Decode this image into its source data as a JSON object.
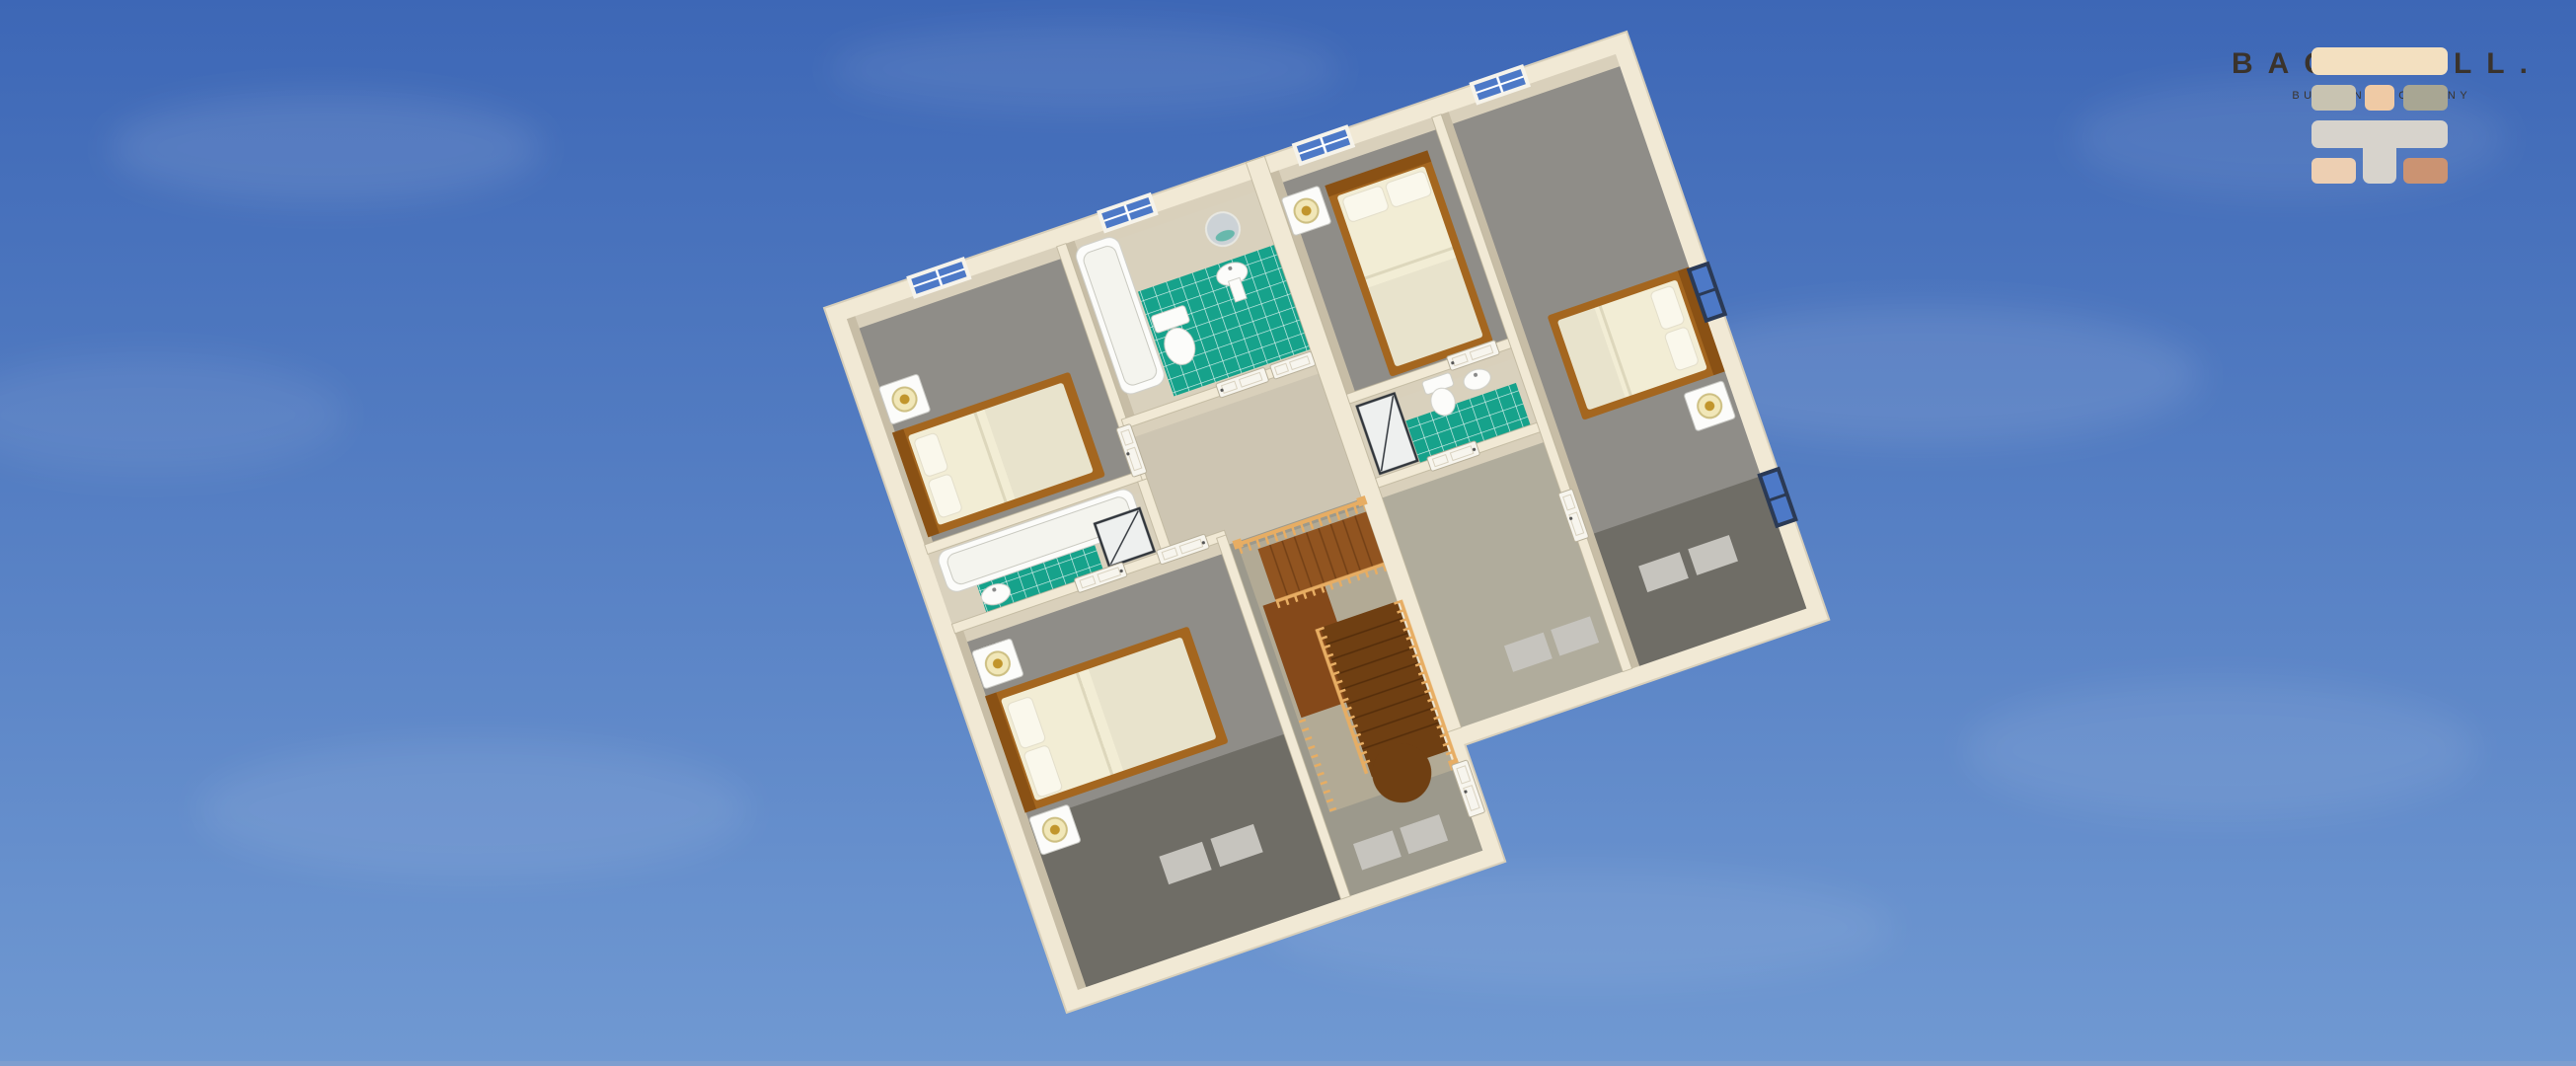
{
  "scene": {
    "description": "3D aerial dollhouse rendering of an upper-storey floor plan floating against a blue sky with faint clouds",
    "rooms": [
      "bedroom-top-left",
      "family-bathroom",
      "ensuite-bathroom-left",
      "master-bedroom",
      "hallway-landing",
      "staircase-u-shaped",
      "bedroom-top-right",
      "ensuite-bathroom-right",
      "bedroom-right",
      "hallway-right"
    ],
    "fixtures": {
      "beds": 4,
      "nightstands": 5,
      "lamps": 5,
      "toilets": 2,
      "sinks": 3,
      "bathtubs": 2,
      "showers": 2,
      "mirrors": 1,
      "windows": 6,
      "doors": 9
    },
    "floorplan_rotation_deg": -19
  },
  "logo": {
    "brand": "BACKWALL.",
    "tagline": "BUILDING COMPANY",
    "icon": "brick-wall-icon"
  },
  "palette": {
    "sky-top": "#3d67b6",
    "sky-bottom": "#7099d2",
    "sky-edge": "#8aa3cc",
    "wall-cream": "#f1e9d5",
    "wall-edge": "#c6bca4",
    "wall-face": "#d9d0bb",
    "wall-face-dark": "#c7bda6",
    "floor-beige": "#cdc5b2",
    "floor-bath": "#d9d1bd",
    "hall-olive": "#9c998c",
    "hall-right": "#b0ac9c",
    "carpet-gray": "#8f8d88",
    "carpet-dark": "#6f6d66",
    "mat-light": "#c6c4be",
    "tile-green": "#16a28b",
    "fixture-white": "#fcfcfa",
    "fixture-edge": "#c9c9c0",
    "wood-frame": "#a4661f",
    "wood-head": "#8a5114",
    "wood-tread": "#915420",
    "wood-landing": "#85491a",
    "wood-dark": "#6f3f12",
    "wood-rail": "#e7ad63",
    "void-floor": "#b2aa95",
    "bedding": "#f2edd5",
    "pillow": "#faf8ec",
    "window-blue": "#4d79c7",
    "window-frame": "#f6f3ea",
    "window-frame-dark": "#2b3a55",
    "door-white": "#f7f5ee",
    "door-edge": "#b8b09a",
    "shower-frame": "#30353b",
    "logo-b1": "#f3e0c0",
    "logo-b2a": "#c8c3b1",
    "logo-b2b": "#efcaa5",
    "logo-b2c": "#a8a693",
    "logo-b3": "#d7d3cc",
    "logo-b4a": "#edcfb2",
    "logo-b4b": "#cb9372",
    "logo-text": "#3a332c"
  }
}
